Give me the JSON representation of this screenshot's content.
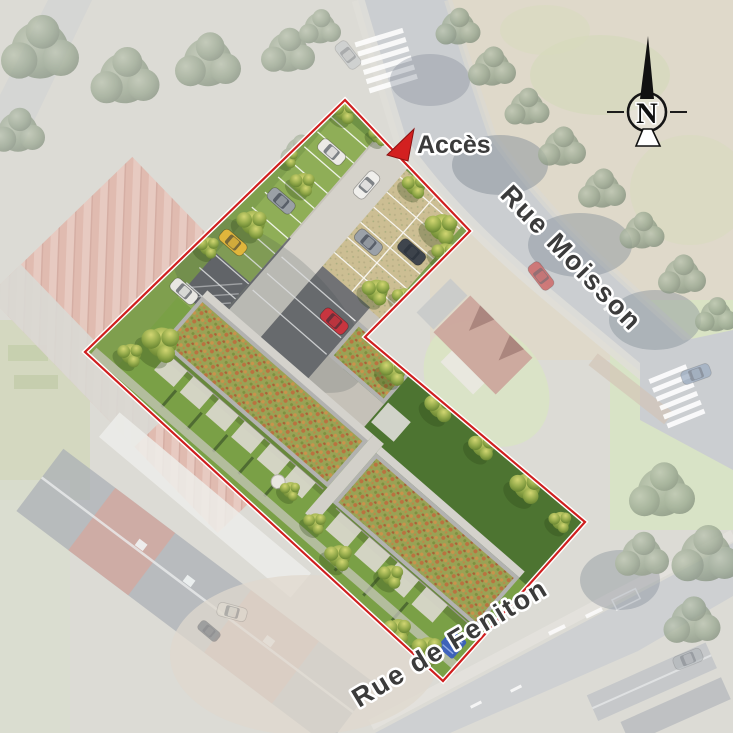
{
  "title": "Plan de masse aérien - résidence",
  "labels": {
    "access": "Accès",
    "street_top": "Rue Moisson",
    "street_bottom": "Rue de Feniton"
  },
  "compass": {
    "letter": "N"
  },
  "site": {
    "boundary_points": "345,100 470,231 365,337 585,522 443,681 85,352",
    "access_arrow_points": "387,155 414,129 408,161"
  },
  "colors": {
    "boundary_red": "#cf1f1f",
    "access_arrow": "#d32020",
    "label_text": "#3b3b3b",
    "label_halo": "#ffffff",
    "lawn_green": "#7aa046",
    "dark_lawn_green": "#4d7431",
    "sedum_roof_green": "#99a255",
    "sedum_flower_orange": "#c06a3c",
    "road_gray": "#bdc1c4"
  }
}
